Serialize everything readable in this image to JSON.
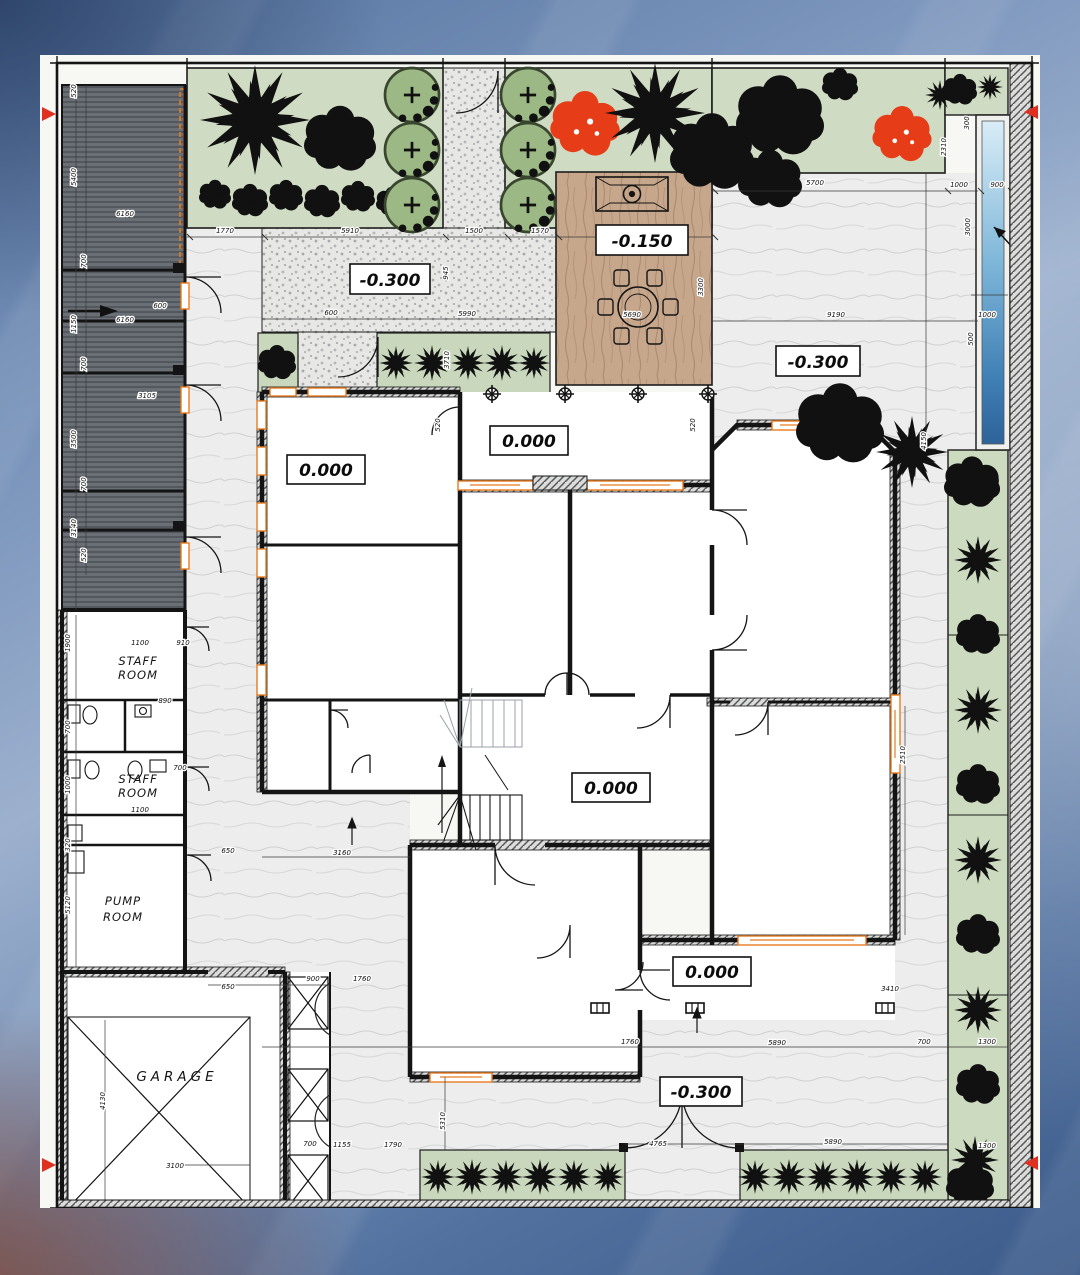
{
  "drawing": {
    "type": "architectural-ground-floor-site-plan"
  },
  "colors": {
    "paper": "#f7f7f4",
    "wall_black": "#141414",
    "window_accent_orange": "#e87b1e",
    "garden_green": "#cfdcc3",
    "hedge_green": "#c9d7bd",
    "canopy_green": "#9cb884",
    "tree_black": "#111111",
    "flowering_tree_red": "#e63c17",
    "terrace_wood_tan": "#c7a78c",
    "pool_blue": "#4f93c4",
    "court_gray": "#ededee",
    "stipple_gray": "#e7e7e5",
    "pergola_gray": "#686d74",
    "section_marker_red": "#e03020",
    "background_blue": "#7b95bc"
  },
  "rooms": {
    "staff_room_1_line1": "STAFF",
    "staff_room_1_line2": "ROOM",
    "staff_room_2_line1": "STAFF",
    "staff_room_2_line2": "ROOM",
    "pump_room_line1": "PUMP",
    "pump_room_line2": "ROOM",
    "garage": "GARAGE"
  },
  "elevations": {
    "plaza": "-0.300",
    "terrace": "-0.150",
    "right_court": "-0.300",
    "left_room": "0.000",
    "veranda": "0.000",
    "hall": "0.000",
    "porch": "0.000",
    "lower_court": "-0.300"
  },
  "dimensions": [
    {
      "x": 185,
      "y": 178,
      "r": 0,
      "t": "1770"
    },
    {
      "x": 310,
      "y": 178,
      "r": 0,
      "t": "5910"
    },
    {
      "x": 434,
      "y": 178,
      "r": 0,
      "t": "1500"
    },
    {
      "x": 500,
      "y": 178,
      "r": 0,
      "t": "1570"
    },
    {
      "x": 291,
      "y": 260,
      "r": 0,
      "t": "600"
    },
    {
      "x": 427,
      "y": 261,
      "r": 0,
      "t": "5990"
    },
    {
      "x": 592,
      "y": 262,
      "r": 0,
      "t": "5690"
    },
    {
      "x": 408,
      "y": 218,
      "r": 90,
      "t": "945"
    },
    {
      "x": 409,
      "y": 305,
      "r": 90,
      "t": "3710"
    },
    {
      "x": 663,
      "y": 232,
      "r": 90,
      "t": "3300"
    },
    {
      "x": 775,
      "y": 130,
      "r": 0,
      "t": "5700"
    },
    {
      "x": 919,
      "y": 132,
      "r": 0,
      "t": "1000"
    },
    {
      "x": 957,
      "y": 132,
      "r": 0,
      "t": "900"
    },
    {
      "x": 906,
      "y": 92,
      "r": 90,
      "t": "2310"
    },
    {
      "x": 929,
      "y": 68,
      "r": 90,
      "t": "300"
    },
    {
      "x": 930,
      "y": 172,
      "r": 90,
      "t": "3000"
    },
    {
      "x": 947,
      "y": 262,
      "r": 0,
      "t": "1000"
    },
    {
      "x": 933,
      "y": 284,
      "r": 90,
      "t": "500"
    },
    {
      "x": 796,
      "y": 262,
      "r": 0,
      "t": "9190"
    },
    {
      "x": 886,
      "y": 386,
      "r": 90,
      "t": "4150"
    },
    {
      "x": 865,
      "y": 700,
      "r": 90,
      "t": "2510"
    },
    {
      "x": 850,
      "y": 936,
      "r": 0,
      "t": "3410"
    },
    {
      "x": 400,
      "y": 370,
      "r": 90,
      "t": "520"
    },
    {
      "x": 655,
      "y": 370,
      "r": 90,
      "t": "520"
    },
    {
      "x": 36,
      "y": 36,
      "r": 90,
      "t": "520"
    },
    {
      "x": 36,
      "y": 122,
      "r": 90,
      "t": "5400"
    },
    {
      "x": 46,
      "y": 206,
      "r": 90,
      "t": "700"
    },
    {
      "x": 36,
      "y": 269,
      "r": 90,
      "t": "1150"
    },
    {
      "x": 46,
      "y": 309,
      "r": 90,
      "t": "700"
    },
    {
      "x": 36,
      "y": 384,
      "r": 90,
      "t": "3500"
    },
    {
      "x": 46,
      "y": 429,
      "r": 90,
      "t": "700"
    },
    {
      "x": 36,
      "y": 473,
      "r": 90,
      "t": "3140"
    },
    {
      "x": 46,
      "y": 500,
      "r": 90,
      "t": "520"
    },
    {
      "x": 85,
      "y": 161,
      "r": 0,
      "t": "6160"
    },
    {
      "x": 120,
      "y": 253,
      "r": 0,
      "t": "600"
    },
    {
      "x": 85,
      "y": 267,
      "r": 0,
      "t": "6160"
    },
    {
      "x": 107,
      "y": 343,
      "r": 0,
      "t": "3105"
    },
    {
      "x": 30,
      "y": 588,
      "r": 90,
      "t": "1900"
    },
    {
      "x": 30,
      "y": 672,
      "r": 90,
      "t": "700"
    },
    {
      "x": 30,
      "y": 730,
      "r": 90,
      "t": "1000"
    },
    {
      "x": 30,
      "y": 790,
      "r": 90,
      "t": "320"
    },
    {
      "x": 30,
      "y": 850,
      "r": 90,
      "t": "5120"
    },
    {
      "x": 100,
      "y": 590,
      "r": 0,
      "t": "1100"
    },
    {
      "x": 143,
      "y": 590,
      "r": 0,
      "t": "910"
    },
    {
      "x": 125,
      "y": 648,
      "r": 0,
      "t": "890"
    },
    {
      "x": 140,
      "y": 715,
      "r": 0,
      "t": "700"
    },
    {
      "x": 100,
      "y": 757,
      "r": 0,
      "t": "1100"
    },
    {
      "x": 188,
      "y": 798,
      "r": 0,
      "t": "650"
    },
    {
      "x": 302,
      "y": 800,
      "r": 0,
      "t": "3160"
    },
    {
      "x": 405,
      "y": 1066,
      "r": 90,
      "t": "5310"
    },
    {
      "x": 188,
      "y": 934,
      "r": 0,
      "t": "650"
    },
    {
      "x": 273,
      "y": 926,
      "r": 0,
      "t": "900"
    },
    {
      "x": 322,
      "y": 926,
      "r": 0,
      "t": "1760"
    },
    {
      "x": 65,
      "y": 1046,
      "r": 90,
      "t": "4130"
    },
    {
      "x": 135,
      "y": 1113,
      "r": 0,
      "t": "3100"
    },
    {
      "x": 270,
      "y": 1091,
      "r": 0,
      "t": "700"
    },
    {
      "x": 302,
      "y": 1092,
      "r": 0,
      "t": "1155"
    },
    {
      "x": 353,
      "y": 1092,
      "r": 0,
      "t": "1790"
    },
    {
      "x": 590,
      "y": 989,
      "r": 0,
      "t": "1760"
    },
    {
      "x": 737,
      "y": 990,
      "r": 0,
      "t": "5890"
    },
    {
      "x": 884,
      "y": 989,
      "r": 0,
      "t": "700"
    },
    {
      "x": 947,
      "y": 989,
      "r": 0,
      "t": "1300"
    },
    {
      "x": 618,
      "y": 1091,
      "r": 0,
      "t": "4765"
    },
    {
      "x": 793,
      "y": 1089,
      "r": 0,
      "t": "5890"
    },
    {
      "x": 947,
      "y": 1093,
      "r": 0,
      "t": "1300"
    }
  ]
}
